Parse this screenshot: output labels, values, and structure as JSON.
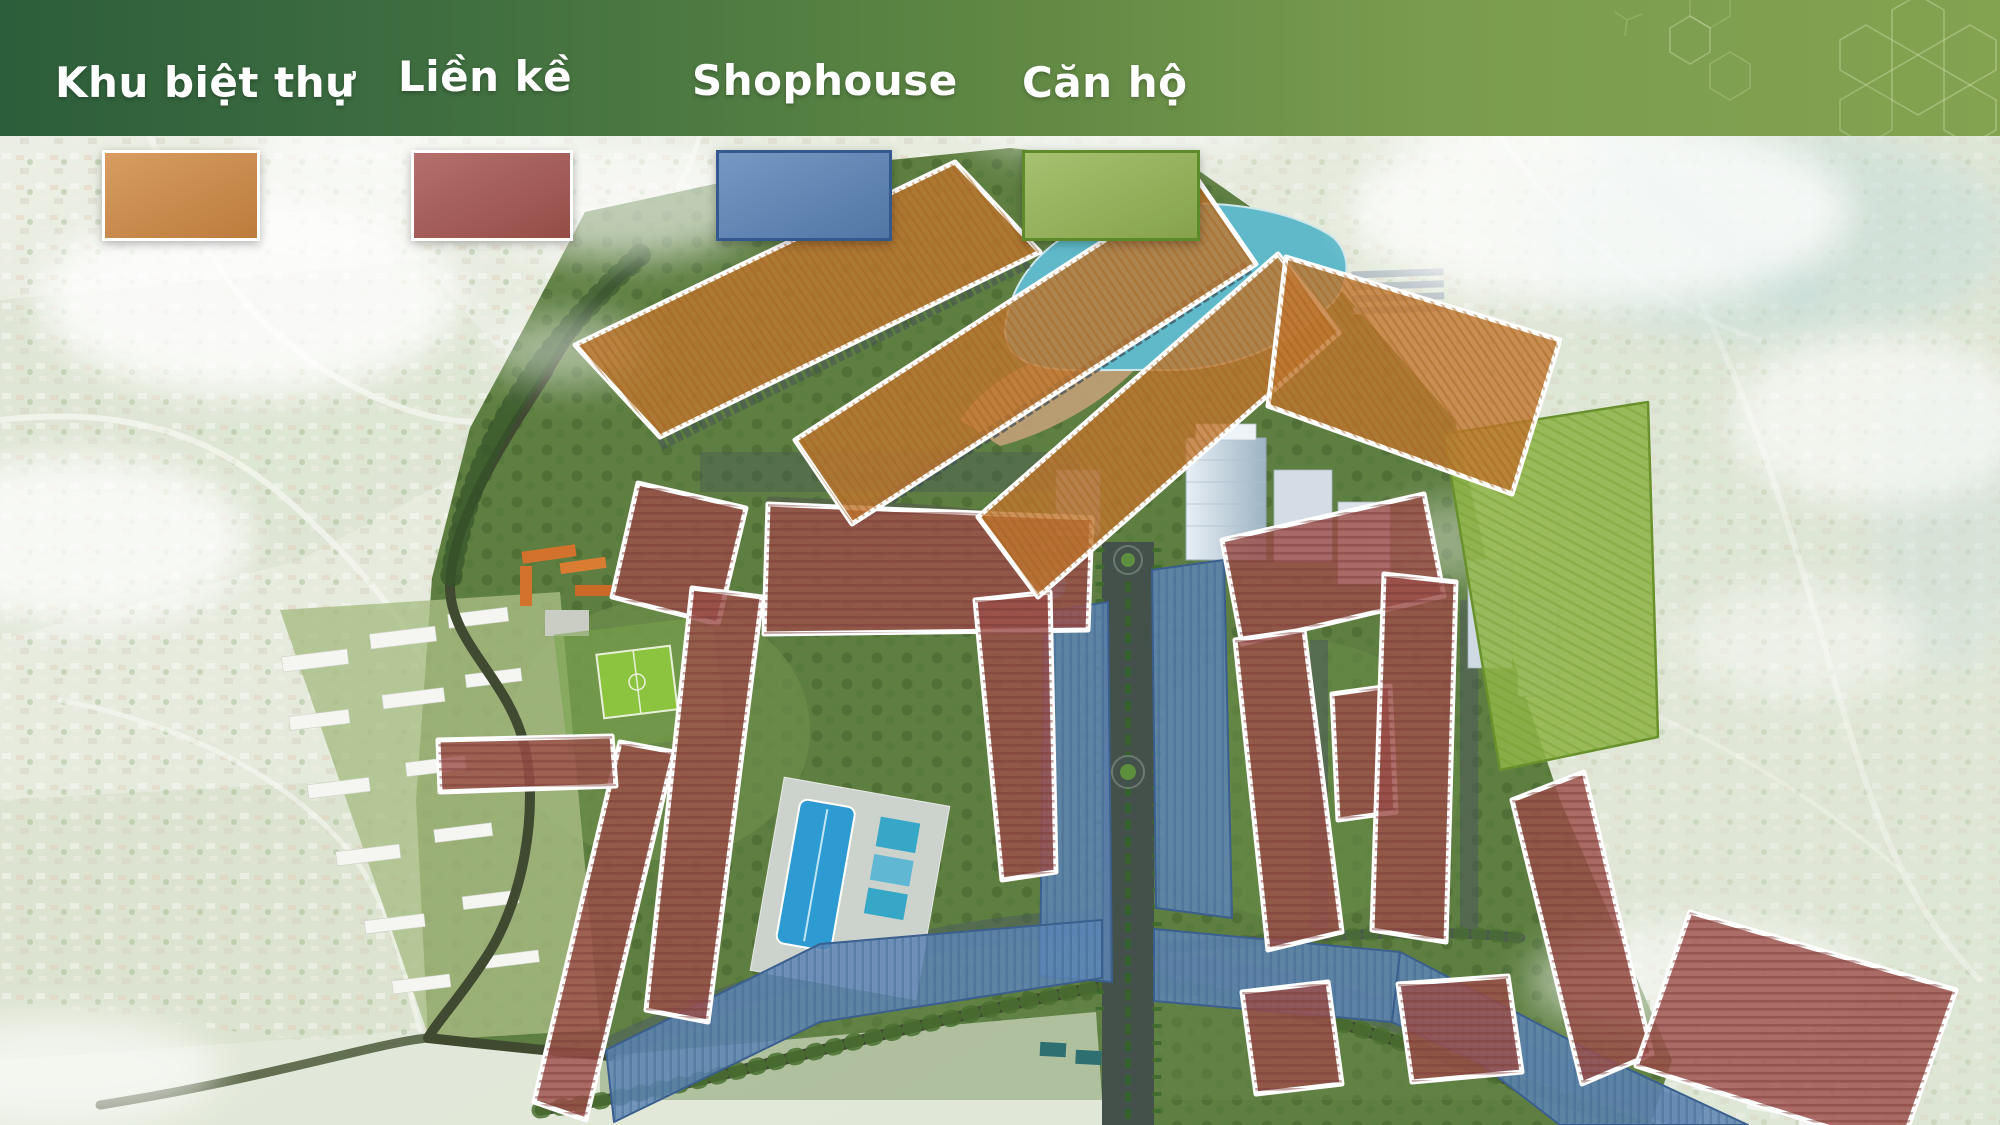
{
  "banner": {
    "accent_dark": "#2c5e3b",
    "accent_light": "#84a351"
  },
  "legend": {
    "items": [
      {
        "label": "Khu biệt thự",
        "fill": "#d18a43",
        "border": "#ffffff",
        "x": 102,
        "width": 152,
        "label_x": 55,
        "label_y": 58
      },
      {
        "label": "Liền kề",
        "fill": "#a65550",
        "border": "#ffffff",
        "x": 411,
        "width": 156,
        "label_x": 398,
        "label_y": 52
      },
      {
        "label": "Shophouse",
        "fill": "#5b84b8",
        "border": "#33598f",
        "x": 716,
        "width": 170,
        "label_x": 692,
        "label_y": 56
      },
      {
        "label": "Căn hộ",
        "fill": "#95b554",
        "border": "#5e8a2a",
        "x": 1022,
        "width": 172,
        "label_x": 1022,
        "label_y": 58
      }
    ]
  },
  "zone_styles": {
    "villa": {
      "fill": "#c0772f",
      "stroke": "#ffffff",
      "fill_opacity": 0.8,
      "stroke_width": 5,
      "pattern": "stripe-villa"
    },
    "terraced": {
      "fill": "#9c4f4b",
      "stroke": "#ffffff",
      "fill_opacity": 0.82,
      "stroke_width": 5,
      "pattern": "stripe-terraced"
    },
    "shophouse": {
      "fill": "#5d85b4",
      "stroke": "#3a5f8e",
      "fill_opacity": 0.85,
      "stroke_width": 2,
      "pattern": "stripe-shophouse"
    },
    "apartment": {
      "fill": "#8fb449",
      "stroke": "#68902c",
      "fill_opacity": 0.88,
      "stroke_width": 2.5,
      "pattern": "stripe-apartment"
    }
  },
  "zones": {
    "shophouse": [
      {
        "name": "shophouse-zone-1",
        "points": "1044,612 1108,602 1112,982 1040,976"
      },
      {
        "name": "shophouse-zone-2",
        "points": "1152,570 1224,560 1232,918 1156,908"
      },
      {
        "name": "shophouse-zone-3",
        "points": "606,1050 820,944 1102,920 1102,978 820,1022 614,1122"
      },
      {
        "name": "shophouse-zone-4",
        "points": "1154,929 1400,952 1392,1022 1154,1001"
      },
      {
        "name": "shophouse-zone-5",
        "points": "1400,952 1600,1056 1748,1125 1560,1125 1478,1062 1392,1022"
      }
    ],
    "apartment": [
      {
        "name": "apartment-zone-1",
        "points": "1444,434 1648,402 1658,737 1500,770"
      }
    ],
    "terraced": [
      {
        "name": "terraced-zone-1",
        "points": "638,483 746,508 718,624 612,597"
      },
      {
        "name": "terraced-zone-2",
        "points": "768,504 1092,518 1088,630 764,634"
      },
      {
        "name": "terraced-zone-3",
        "points": "975,600 1050,592 1056,872 1002,880"
      },
      {
        "name": "terraced-zone-4",
        "points": "620,742 674,752 586,1120 534,1102"
      },
      {
        "name": "terraced-zone-5",
        "points": "692,588 762,597 708,1022 646,1010"
      },
      {
        "name": "terraced-zone-6",
        "points": "438,740 612,736 616,786 440,792"
      },
      {
        "name": "terraced-zone-7",
        "points": "1222,540 1424,494 1444,596 1242,644"
      },
      {
        "name": "terraced-zone-8",
        "points": "1235,640 1304,630 1342,932 1268,950"
      },
      {
        "name": "terraced-zone-9",
        "points": "1332,694 1390,686 1396,812 1338,820"
      },
      {
        "name": "terraced-zone-10",
        "points": "1384,574 1456,582 1446,942 1372,930"
      },
      {
        "name": "terraced-zone-11",
        "points": "1512,800 1584,772 1652,1054 1582,1084"
      },
      {
        "name": "terraced-zone-12",
        "points": "1690,912 1956,990 1900,1150 1636,1066"
      },
      {
        "name": "terraced-zone-13",
        "points": "1242,992 1328,982 1342,1084 1256,1094"
      },
      {
        "name": "terraced-zone-14",
        "points": "1398,984 1508,976 1522,1072 1412,1082"
      }
    ],
    "villa": [
      {
        "name": "villa-zone-1",
        "points": "575,345 955,162 1040,252 660,437"
      },
      {
        "name": "villa-zone-2",
        "points": "795,440 1198,180 1256,264 852,524"
      },
      {
        "name": "villa-zone-3",
        "points": "978,517 1278,254 1340,332 1038,597"
      },
      {
        "name": "villa-zone-4",
        "points": "1286,257 1560,340 1512,494 1268,406"
      }
    ]
  }
}
